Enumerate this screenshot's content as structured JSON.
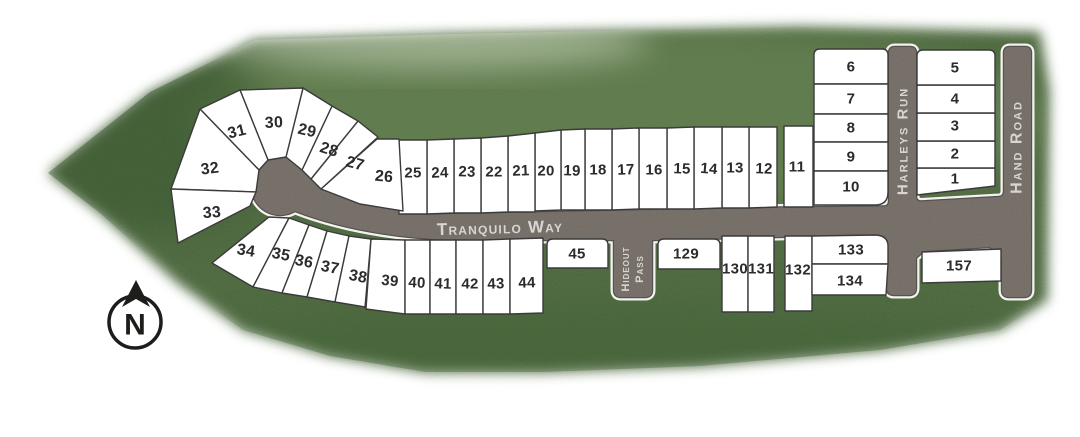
{
  "roads": {
    "tranquilo_way": "Tranquilo Way",
    "hideout_pass_line1": "Hideout",
    "hideout_pass_line2": "Pass",
    "harleys_run": "Harleys Run",
    "hand_road": "Hand Road"
  },
  "compass": {
    "north_label": "N"
  },
  "lots": [
    "1",
    "2",
    "3",
    "4",
    "5",
    "6",
    "7",
    "8",
    "9",
    "10",
    "11",
    "12",
    "13",
    "14",
    "15",
    "16",
    "17",
    "18",
    "19",
    "20",
    "21",
    "22",
    "23",
    "24",
    "25",
    "26",
    "27",
    "28",
    "29",
    "30",
    "31",
    "32",
    "33",
    "34",
    "35",
    "36",
    "37",
    "38",
    "39",
    "40",
    "41",
    "42",
    "43",
    "44",
    "45",
    "129",
    "130",
    "131",
    "132",
    "133",
    "134",
    "157"
  ],
  "colors": {
    "grass": "#567347",
    "road": "#7f7770",
    "road_edge_light": "#f3f2ef",
    "road_edge_dark": "#55524f",
    "lot_fill": "#ffffff",
    "lot_border": "#3b3b3b",
    "lot_number": "#2b2b2b",
    "road_label": "#d9d6d2",
    "compass": "#1d1d1b"
  }
}
